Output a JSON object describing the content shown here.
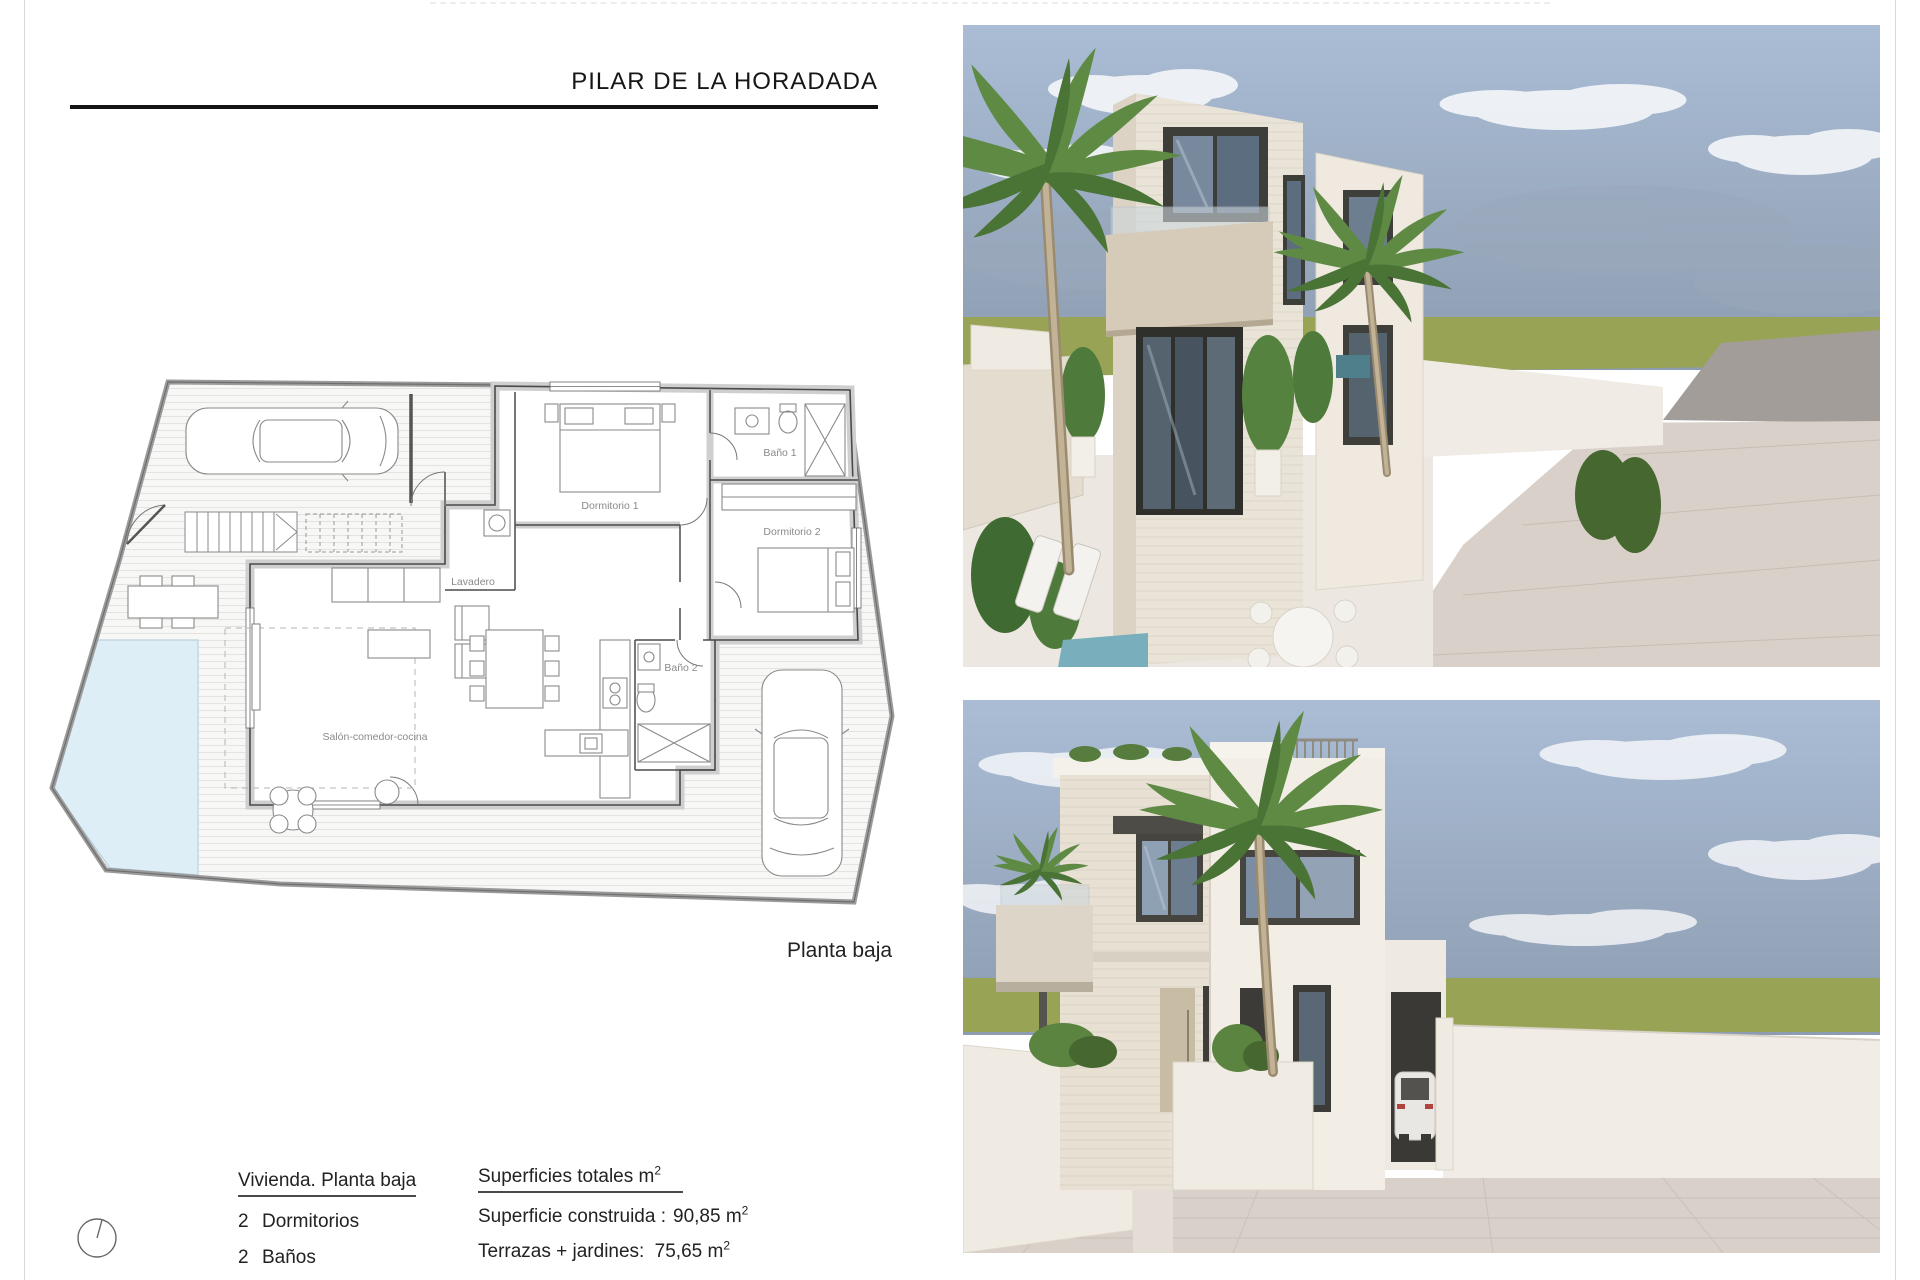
{
  "page": {
    "title": "PILAR DE LA HORADADA",
    "plan_caption": "Planta baja"
  },
  "plan": {
    "rooms": [
      {
        "label": "Dormitorio 1"
      },
      {
        "label": "Baño 1"
      },
      {
        "label": "Dormitorio 2"
      },
      {
        "label": "Lavadero"
      },
      {
        "label": "Baño 2"
      },
      {
        "label": "Salón-comedor-cocina"
      }
    ]
  },
  "details": {
    "heading": "Vivienda. Planta baja",
    "items": [
      {
        "count": "2",
        "label": "Dormitorios"
      },
      {
        "count": "2",
        "label": "Baños"
      }
    ]
  },
  "surfaces": {
    "heading": "Superficies totales m",
    "heading_sup": "2",
    "rows": [
      {
        "label": "Superficie construida :",
        "value": "90,85 m",
        "sup": "2"
      },
      {
        "label": "Terrazas + jardines:",
        "value": "75,65 m",
        "sup": "2"
      }
    ]
  },
  "colors": {
    "pool": "#ddeef6",
    "grass": "#98a355",
    "sky_top": "#aabdd5",
    "sky_horizon": "#8d9cb0",
    "facade_light": "#ece6da",
    "facade_shadow": "#d6cdbd",
    "window_frame": "#44443f",
    "paving": "#d9d1c9",
    "plan_wall": "#4a4a4a",
    "label_gray": "#8a8a8a"
  }
}
